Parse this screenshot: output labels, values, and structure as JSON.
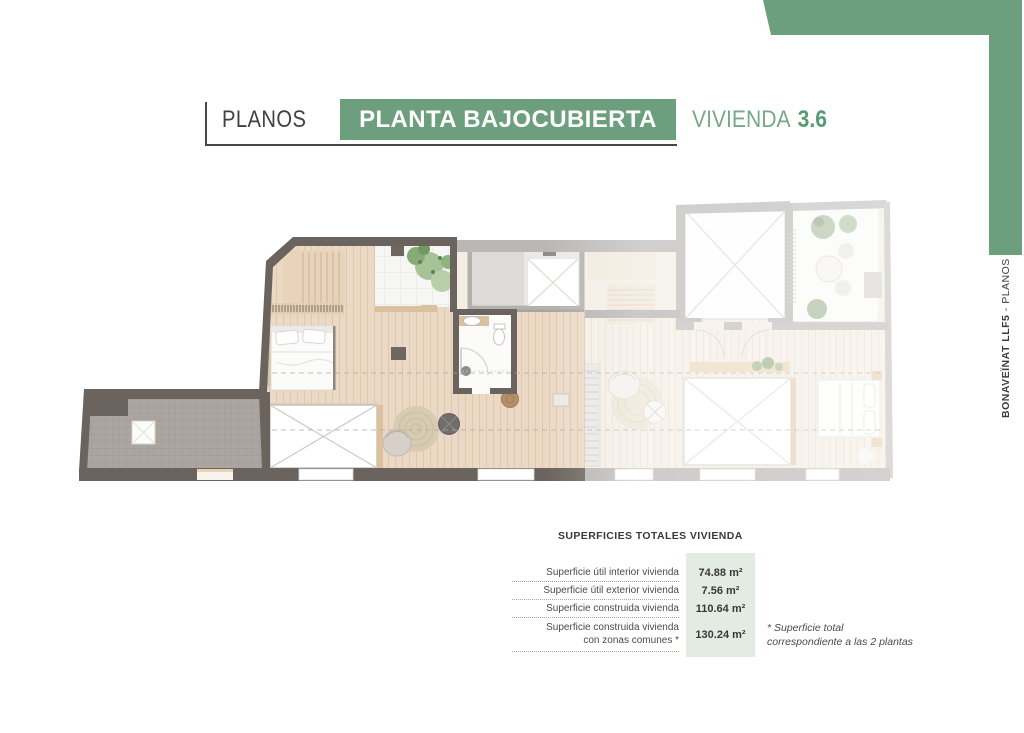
{
  "header": {
    "section_label": "PLANOS",
    "sheet_title": "PLANTA BAJOCUBIERTA",
    "unit_label": "VIVIENDA",
    "unit_number": "3.6"
  },
  "side_tab": {
    "project": "BONAVEÏNAT LLF5",
    "suffix": " - PLANOS"
  },
  "areas_table": {
    "title": "SUPERFICIES TOTALES VIVIENDA",
    "rows": [
      {
        "label": "Superficie útil interior vivienda",
        "value": "74.88 m²"
      },
      {
        "label": "Superficie útil exterior vivienda",
        "value": "7.56 m²"
      },
      {
        "label": "Superficie construida vivienda",
        "value": "110.64 m²"
      },
      {
        "label": "Superficie construida vivienda",
        "label_line2": "con zonas comunes *",
        "value": "130.24 m²"
      }
    ],
    "footnote": [
      "* Superficie total",
      "correspondiente a las 2 plantas"
    ]
  },
  "colors": {
    "accent_green": "#6d9e7d",
    "value_box_green": "#e3ece3",
    "wall_dark": "#6b635d",
    "wall_faded": "#b7b5b2",
    "wood_floor": "#ebd9c5",
    "terrace_tile": "#aca49e"
  },
  "floor_plan": {
    "type": "architectural-plan",
    "level": "Planta bajocubierta",
    "unit": "3.6",
    "features": [
      "stairs",
      "double-bed",
      "bathroom",
      "skylight-patio",
      "roof-terrace",
      "wardrobe-hatch",
      "round-rug",
      "armchair",
      "round-table",
      "plants",
      "adjacent-area-faded"
    ]
  }
}
